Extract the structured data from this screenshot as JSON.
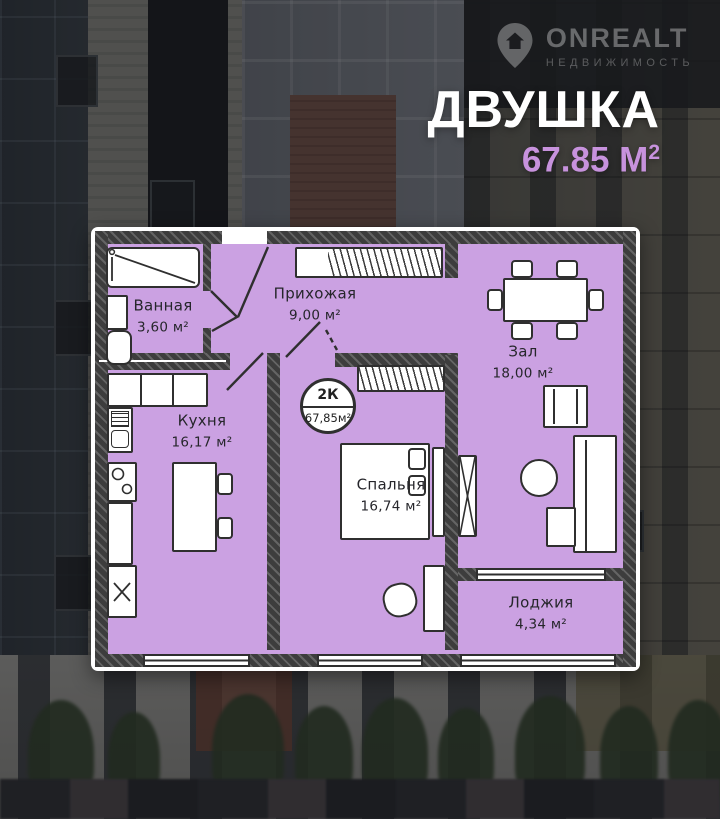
{
  "brand": {
    "name": "ONREALT",
    "tagline": "НЕДВИЖИМОСТЬ"
  },
  "header": {
    "title": "ДВУШКА",
    "area_value": "67.85 М",
    "area_sup": "2"
  },
  "plan": {
    "badge": {
      "rooms_label": "2К",
      "area_label": "67,85м²"
    },
    "rooms": [
      {
        "name": "Ванная",
        "area": "3,60 м²"
      },
      {
        "name": "Прихожая",
        "area": "9,00 м²"
      },
      {
        "name": "Зал",
        "area": "18,00 м²"
      },
      {
        "name": "Кухня",
        "area": "16,17 м²"
      },
      {
        "name": "Спальня",
        "area": "16,74 м²"
      },
      {
        "name": "Лоджия",
        "area": "4,34 м²"
      }
    ]
  },
  "colors": {
    "floor": "#cba1e2",
    "accent": "#c792dd",
    "wall": "#3f3f3f",
    "frame": "#ffffff"
  }
}
